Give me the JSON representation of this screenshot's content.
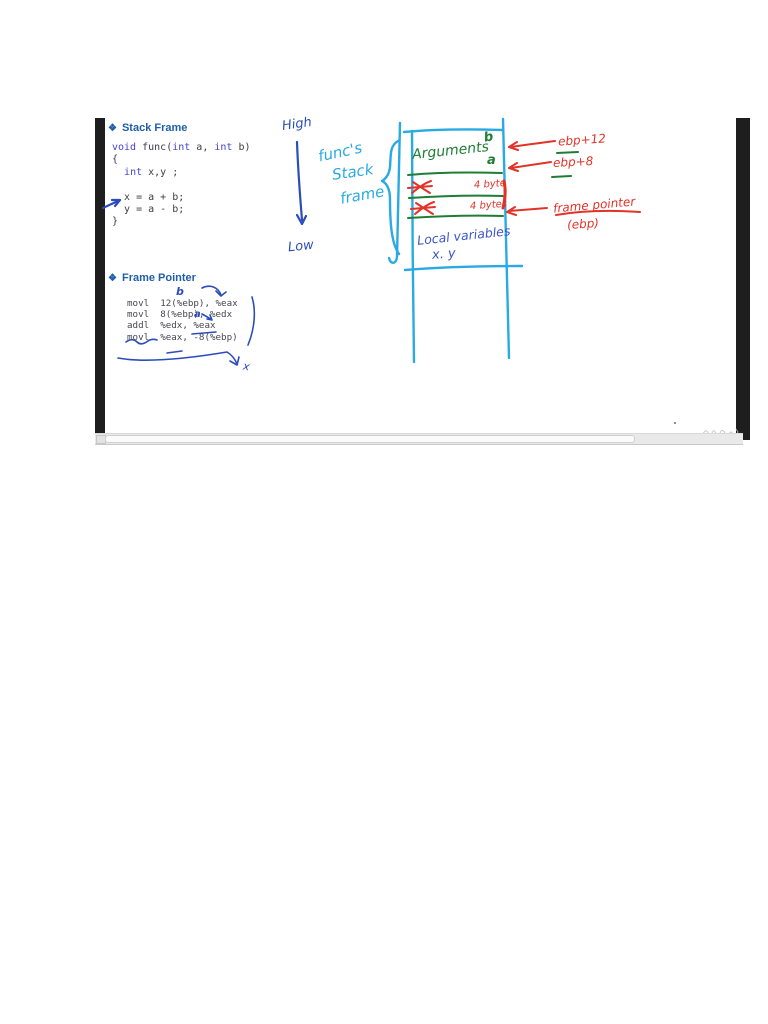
{
  "slide": {
    "sections": [
      {
        "bullet": "❖",
        "title": "Stack Frame"
      },
      {
        "bullet": "❖",
        "title": "Frame Pointer"
      }
    ],
    "c_code": [
      [
        {
          "t": "void",
          "c": "kw"
        },
        {
          "t": " func(",
          "c": "pl"
        },
        {
          "t": "int",
          "c": "kw"
        },
        {
          "t": " a, ",
          "c": "pl"
        },
        {
          "t": "int",
          "c": "kw"
        },
        {
          "t": " b)",
          "c": "pl"
        }
      ],
      [
        {
          "t": "{",
          "c": "pl"
        }
      ],
      [
        {
          "t": "  ",
          "c": "pl"
        },
        {
          "t": "int",
          "c": "kw"
        },
        {
          "t": " x,y ;",
          "c": "pl"
        }
      ],
      [],
      [
        {
          "t": "  x = a + b;",
          "c": "pl"
        }
      ],
      [
        {
          "t": "  y = a - b;",
          "c": "pl"
        }
      ],
      [
        {
          "t": "}",
          "c": "pl"
        }
      ]
    ],
    "asm_code": [
      "movl  12(%ebp), %eax",
      "movl  8(%ebp), %edx",
      "addl  %edx, %eax",
      "movl  %eax, -8(%ebp)"
    ],
    "handwritten": {
      "high": "High",
      "low": "Low",
      "func_line1": "func's",
      "func_line2": "Stack",
      "func_line3": "frame",
      "arguments": "Arguments",
      "arg_b": "b",
      "arg_a": "a",
      "byte1": "4 byte",
      "byte2": "4 bytes",
      "local_line1": "Local variables",
      "local_line2": "x. y",
      "ebp12": "ebp+12",
      "ebp8": "ebp+8",
      "fp_line1": "frame pointer",
      "fp_line2": "(ebp)",
      "asm_b": "b",
      "asm_a": "a",
      "asm_x": "x"
    }
  },
  "colors": {
    "heading_blue": "#1f5fa8",
    "code_keyword": "#4444cc",
    "code_text": "#3d3d46",
    "ink_dark_blue": "#2b4dbb",
    "ink_cyan": "#2aaae2",
    "ink_green": "#1e7e34",
    "ink_red": "#e23328",
    "letterbox_black": "#1e1e1e"
  }
}
